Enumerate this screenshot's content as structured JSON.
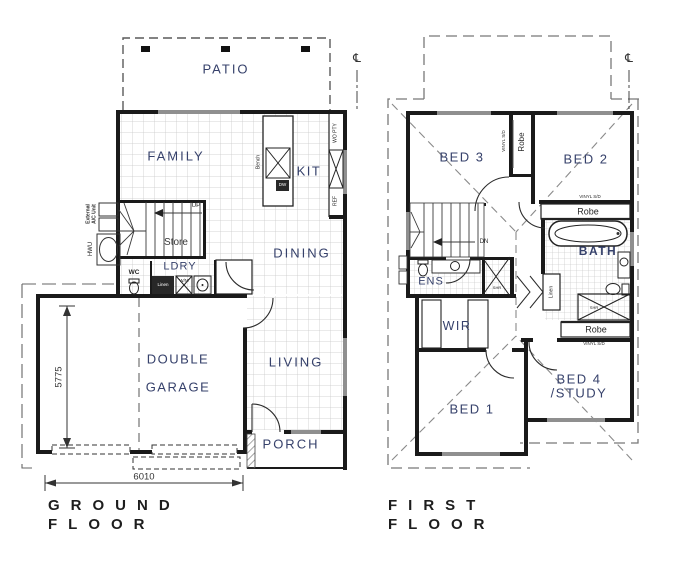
{
  "colors": {
    "wall": "#1a1a1a",
    "room_label": "#36416b",
    "annotation": "#2a2a2a",
    "title": "#1d1d1d"
  },
  "symbols": {
    "centerline": "℄"
  },
  "ground_floor": {
    "title_line1": "GROUND",
    "title_line2": "FLOOR",
    "rooms": {
      "patio": "PATIO",
      "family": "FAMILY",
      "kitchen": "KIT",
      "dining": "DINING",
      "laundry": "LDRY",
      "wc": "WC",
      "garage_line1": "DOUBLE",
      "garage_line2": "GARAGE",
      "living": "LIVING",
      "porch": "PORCH",
      "store": "Store"
    },
    "fixtures": {
      "up": "UP",
      "linen": "Linen",
      "washing_machine": "W/M",
      "dishwasher": "DW",
      "bench": "Bench",
      "wall_oven_pantry": "WO PTY",
      "fridge": "REF",
      "hot_water_unit": "HWU",
      "external_ac_line1": "External",
      "external_ac_line2": "A/C Unit"
    },
    "dimensions": {
      "garage_depth": "5775",
      "garage_width": "6010"
    }
  },
  "first_floor": {
    "title_line1": "FIRST",
    "title_line2": "FLOOR",
    "rooms": {
      "bed1": "BED 1",
      "bed2": "BED 2",
      "bed3": "BED 3",
      "bed4_line1": "BED 4",
      "bed4_line2": "/STUDY",
      "wir": "WIR",
      "ensuite": "ENS",
      "bath": "BATH"
    },
    "fixtures": {
      "down": "DN",
      "robe": "Robe",
      "linen": "Linen",
      "shower": "SHR",
      "vinyl_sliding_door": "VINYL S/D"
    }
  }
}
